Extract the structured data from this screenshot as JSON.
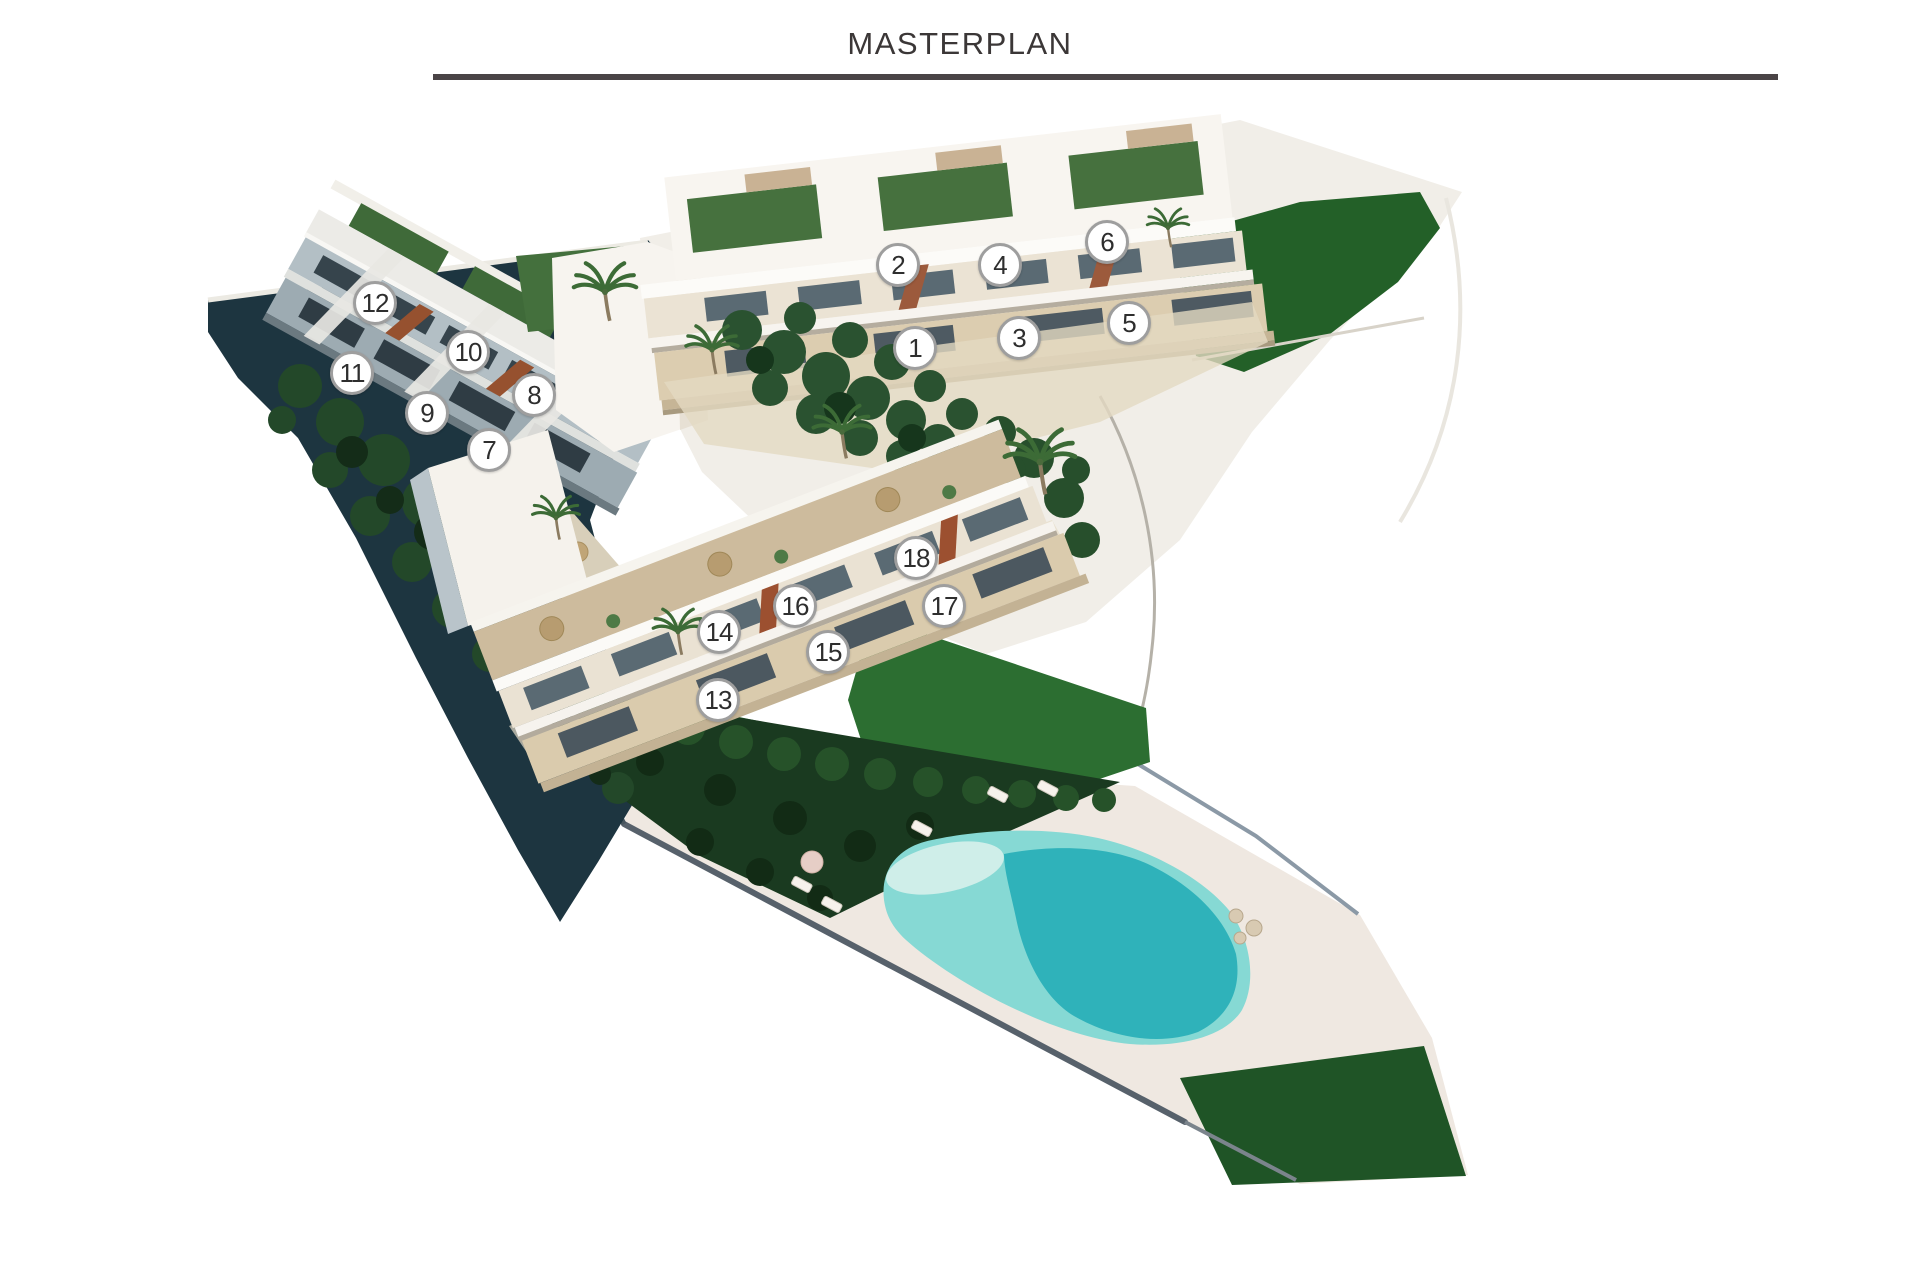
{
  "page": {
    "title": "MASTERPLAN"
  },
  "style": {
    "title_color": "#3b3737",
    "divider_color": "#4a4446",
    "marker_fill": "#ffffff",
    "marker_border": "#9e9e9e",
    "marker_text_color": "#2e2e2e"
  },
  "palette": {
    "pool_shallow": "#86d9d4",
    "pool_deep": "#2fb2ba",
    "pool_beach": "#cfeee9",
    "pool_deck": "#efe8e1",
    "lawn_green": "#2c6e31",
    "grass_dark": "#1f5426",
    "hedge_green": "#1a3a20",
    "slope_shadow": "#1d3540",
    "building_white": "#f7f4ef",
    "stone_beige": "#d9cbae",
    "terrace_tan": "#cdbb9d",
    "roof_garden_green": "#46713e",
    "window_glass": "#4e5a62",
    "shaded_facade": "#9dabb2"
  },
  "markers": [
    {
      "id": "1",
      "x": 915,
      "y": 348
    },
    {
      "id": "2",
      "x": 898,
      "y": 265
    },
    {
      "id": "3",
      "x": 1019,
      "y": 338
    },
    {
      "id": "4",
      "x": 1000,
      "y": 265
    },
    {
      "id": "5",
      "x": 1129,
      "y": 323
    },
    {
      "id": "6",
      "x": 1107,
      "y": 242
    },
    {
      "id": "7",
      "x": 489,
      "y": 450
    },
    {
      "id": "8",
      "x": 534,
      "y": 395
    },
    {
      "id": "9",
      "x": 427,
      "y": 413
    },
    {
      "id": "10",
      "x": 468,
      "y": 352
    },
    {
      "id": "11",
      "x": 352,
      "y": 373
    },
    {
      "id": "12",
      "x": 375,
      "y": 303
    },
    {
      "id": "13",
      "x": 718,
      "y": 700
    },
    {
      "id": "14",
      "x": 719,
      "y": 632
    },
    {
      "id": "15",
      "x": 828,
      "y": 652
    },
    {
      "id": "16",
      "x": 795,
      "y": 606
    },
    {
      "id": "17",
      "x": 944,
      "y": 606
    },
    {
      "id": "18",
      "x": 916,
      "y": 558
    }
  ]
}
